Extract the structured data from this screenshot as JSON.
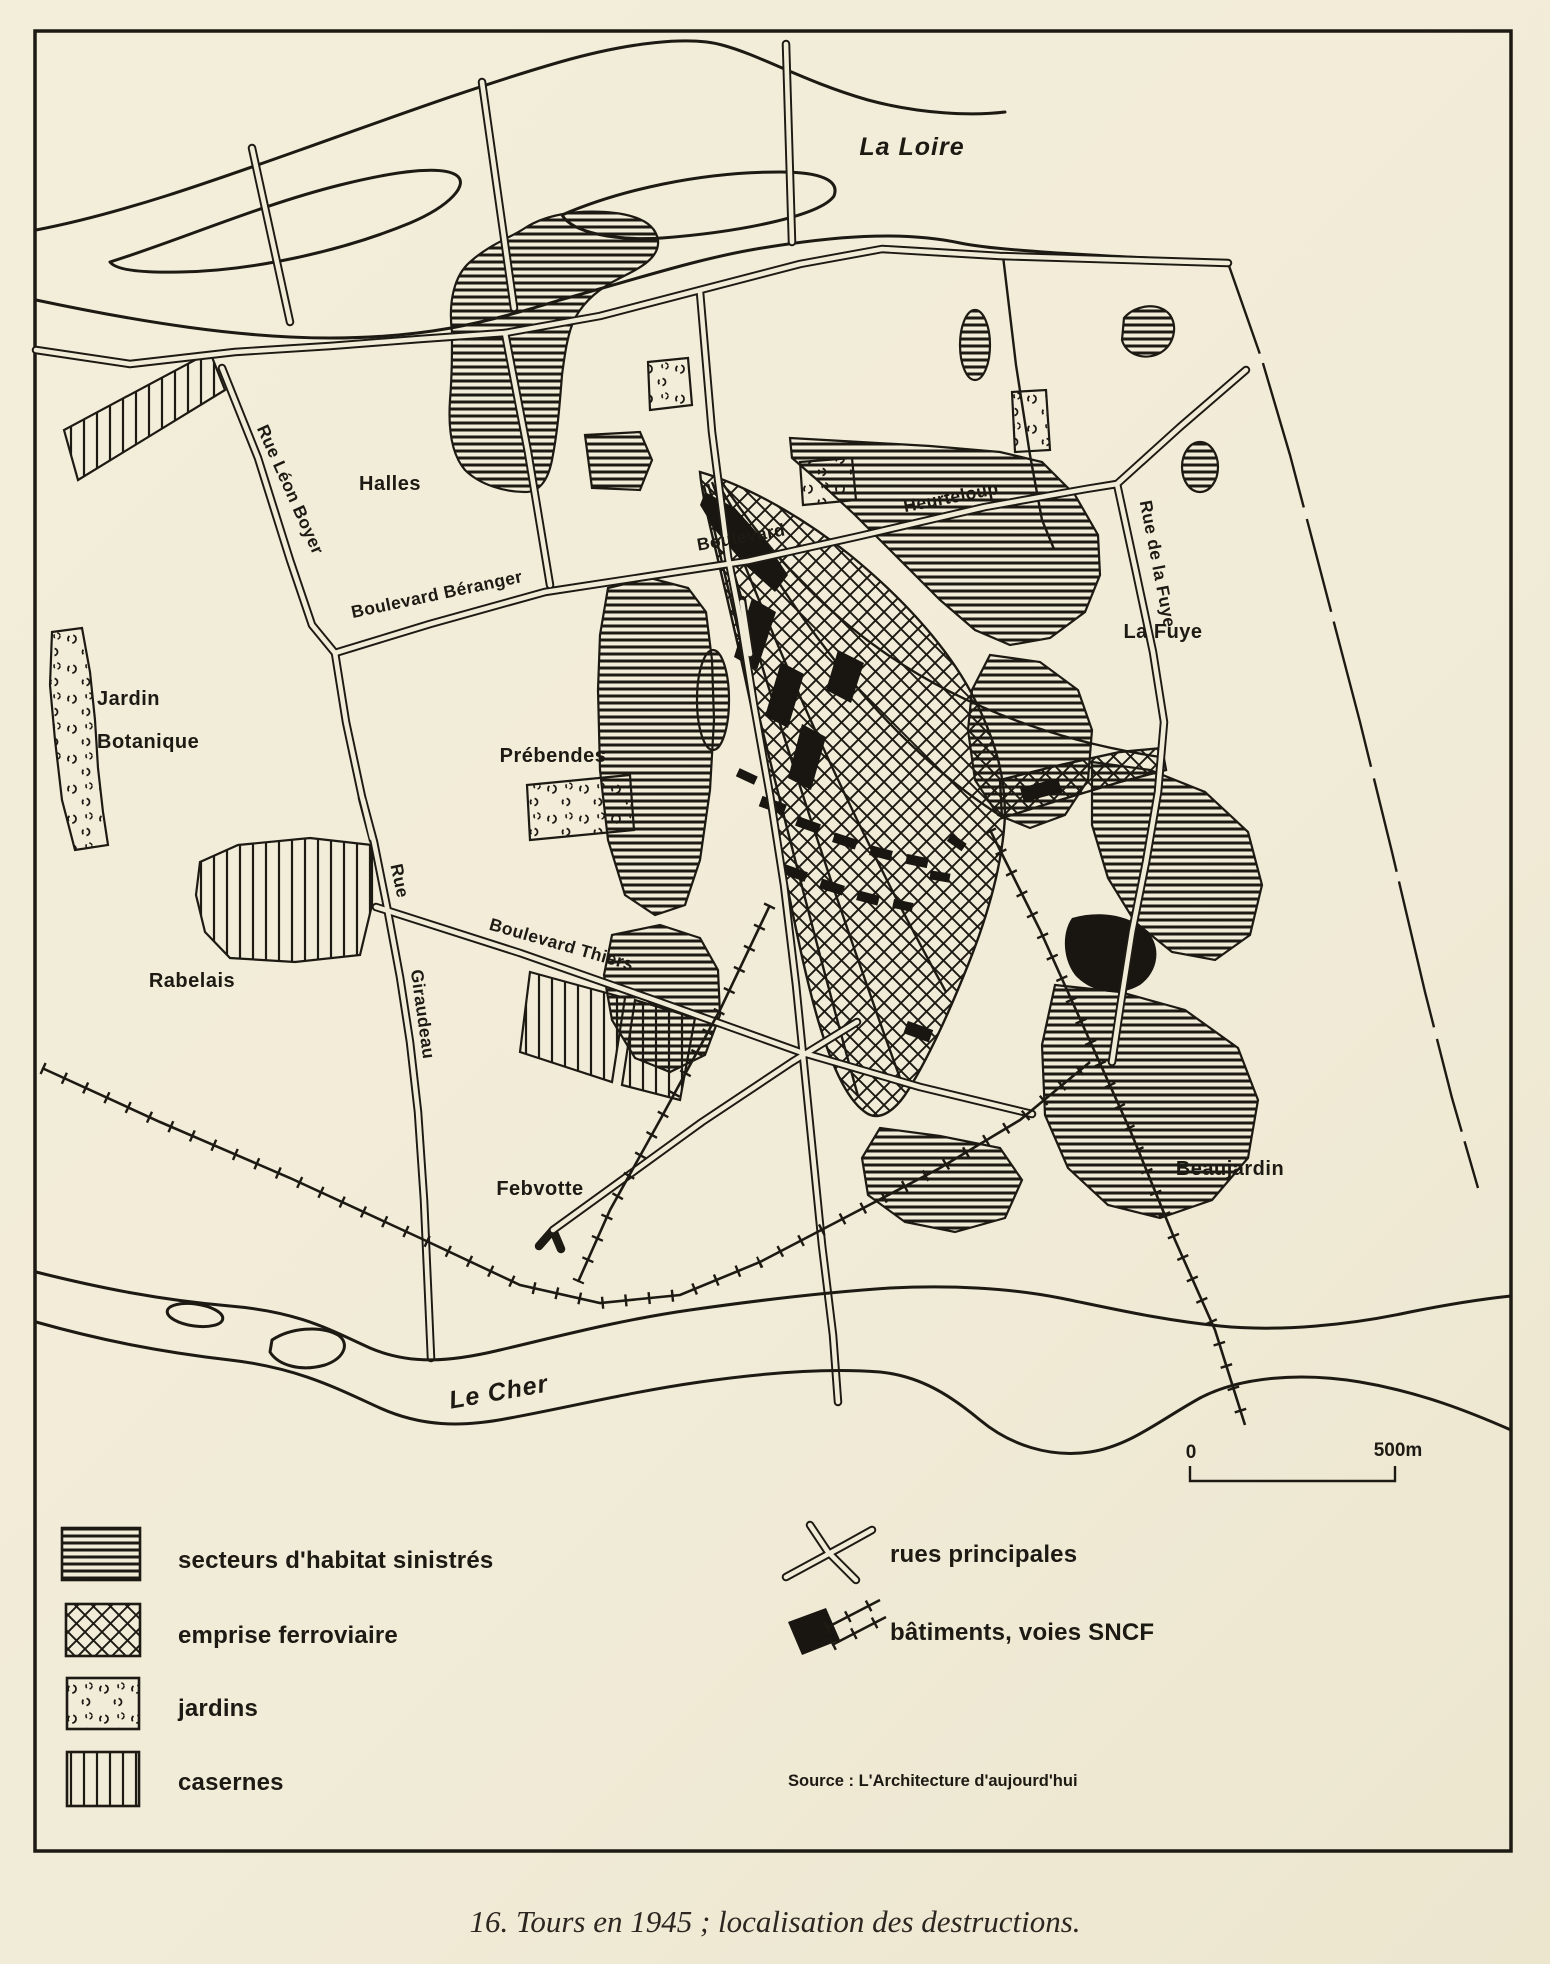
{
  "map": {
    "rivers": {
      "loire": "La Loire",
      "cher": "Le Cher"
    },
    "areas": {
      "halles": "Halles",
      "jardin_line1": "Jardin",
      "jardin_line2": "Botanique",
      "prebendes": "Prébendes",
      "rabelais": "Rabelais",
      "febvotte": "Febvotte",
      "la_fuye": "La Fuye",
      "beaujardin": "Beaujardin"
    },
    "streets": {
      "rue_leon_boyer": "Rue Léon Boyer",
      "bd_beranger": "Boulevard Béranger",
      "bd_heurteloup_word1": "Boulevard",
      "bd_heurteloup_word2": "Heurteloup",
      "rue_de_la_fuye": "Rue de la Fuye",
      "rue_giraudeau_word1": "Rue",
      "rue_giraudeau_word2": "Giraudeau",
      "bd_thiers": "Boulevard Thiers"
    },
    "scale": {
      "zero": "0",
      "max": "500m"
    }
  },
  "legend": {
    "items": [
      {
        "label": "secteurs d'habitat sinistrés",
        "pattern": "horizontal-hatch"
      },
      {
        "label": "emprise ferroviaire",
        "pattern": "crosshatch"
      },
      {
        "label": "jardins",
        "pattern": "speckle"
      },
      {
        "label": "casernes",
        "pattern": "vertical-hatch"
      }
    ],
    "right_items": [
      {
        "label": "rues principales",
        "symbol": "crossing-streets"
      },
      {
        "label": "bâtiments, voies SNCF",
        "symbol": "black-building-with-tracks"
      }
    ],
    "source": "Source : L'Architecture d'aujourd'hui"
  },
  "caption": "16. Tours en 1945 ; localisation des destructions.",
  "colors": {
    "paper": "#f1ecd8",
    "ink": "#1d1a14"
  }
}
